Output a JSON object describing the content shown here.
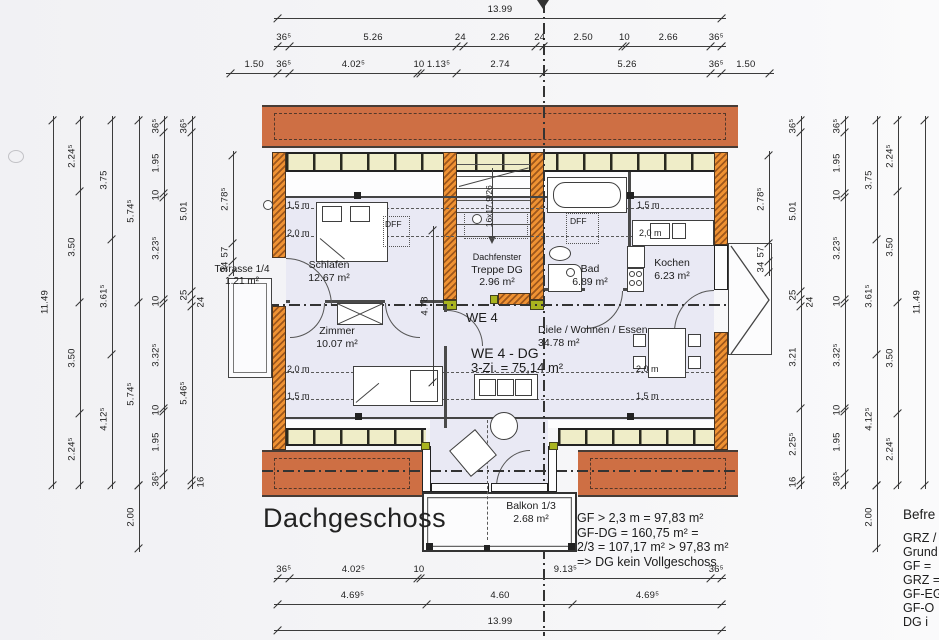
{
  "title": "Dachgeschoss",
  "apartment": {
    "we": "WE 4",
    "unit": "WE 4 - DG",
    "size": "3-Zi. = 75,14 m²"
  },
  "rooms": {
    "terrasse": {
      "name": "Terrasse 1/4",
      "area": "1.21 m²"
    },
    "schlafen": {
      "name": "Schlafen",
      "area": "12.67 m²"
    },
    "zimmer": {
      "name": "Zimmer",
      "area": "10.07 m²"
    },
    "treppe": {
      "name": "Treppe DG",
      "area": "2.96 m²",
      "note": "Dachfenster"
    },
    "bad": {
      "name": "Bad",
      "area": "6.89 m²"
    },
    "kochen": {
      "name": "Kochen",
      "area": "6.23 m²"
    },
    "diele": {
      "name": "Diele / Wohnen / Essen",
      "area": "34.78 m²"
    },
    "balkon": {
      "name": "Balkon 1/3",
      "area": "2.68 m²"
    }
  },
  "labels": {
    "dff": "DFF",
    "stair": "16x17,9/26",
    "h15": "1,5 m",
    "h20": "2,0 m"
  },
  "notes": {
    "calc": [
      "GF > 2,3 m = 97,83 m²",
      "GF-DG = 160,75 m² =",
      "2/3 = 107,17 m² > 97,83 m²",
      "=> DG kein Vollgeschoss"
    ],
    "right": [
      "Befre",
      "GRZ /",
      "Grund",
      "GF =",
      "GRZ =",
      "GF-EG",
      "GF-O",
      "DG i"
    ]
  },
  "colors": {
    "roof": "#ce6f44",
    "wall_hatch": "#ef9233",
    "window_band": "#efedc8",
    "floor": "#e9e9f4",
    "accent_green": "#a9b41f"
  },
  "scale_px_per_m": 31.74,
  "dim_chains": [
    {
      "name": "top-total",
      "axis": "h",
      "line": 18,
      "start": 278,
      "segs": [
        {
          "t": "13.99",
          "m": 13.99
        }
      ]
    },
    {
      "name": "top-row2",
      "axis": "h",
      "line": 46,
      "start": 278,
      "segs": [
        {
          "t": "36⁵",
          "m": 0.365
        },
        {
          "t": "5.26",
          "m": 5.26
        },
        {
          "t": "24",
          "m": 0.24
        },
        {
          "t": "2.26",
          "m": 2.26
        },
        {
          "t": "24",
          "m": 0.24
        },
        {
          "t": "2.50",
          "m": 2.5
        },
        {
          "t": "10",
          "m": 0.1
        },
        {
          "t": "2.66",
          "m": 2.66
        },
        {
          "t": "36⁵",
          "m": 0.365
        }
      ]
    },
    {
      "name": "top-row3",
      "axis": "h",
      "line": 73,
      "start": 230.4,
      "segs": [
        {
          "t": "1.50",
          "m": 1.5
        },
        {
          "t": "36⁵",
          "m": 0.365
        },
        {
          "t": "4.02⁵",
          "m": 4.025
        },
        {
          "t": "10",
          "m": 0.1
        },
        {
          "t": "1.13⁵",
          "m": 1.135
        },
        {
          "t": "2.74",
          "m": 2.74
        },
        {
          "t": "5.26",
          "m": 5.26
        },
        {
          "t": "36⁵",
          "m": 0.365
        },
        {
          "t": "1.50",
          "m": 1.5
        }
      ]
    },
    {
      "name": "bottom-row1",
      "axis": "h",
      "line": 578,
      "start": 278,
      "segs": [
        {
          "t": "36⁵",
          "m": 0.365
        },
        {
          "t": "4.02⁵",
          "m": 4.025
        },
        {
          "t": "10",
          "m": 0.1
        },
        {
          "t": "9.13⁵",
          "m": 9.135
        },
        {
          "t": "36⁵",
          "m": 0.365
        }
      ]
    },
    {
      "name": "bottom-row2",
      "axis": "h",
      "line": 604,
      "start": 278,
      "segs": [
        {
          "t": "4.69⁵",
          "m": 4.695
        },
        {
          "t": "4.60",
          "m": 4.6
        },
        {
          "t": "4.69⁵",
          "m": 4.695
        }
      ]
    },
    {
      "name": "bottom-total",
      "axis": "h",
      "line": 630,
      "start": 278,
      "segs": [
        {
          "t": "13.99",
          "m": 13.99
        }
      ]
    },
    {
      "name": "left-total",
      "axis": "v",
      "line": 53,
      "start": 120,
      "segs": [
        {
          "t": "11.49",
          "m": 11.49
        }
      ]
    },
    {
      "name": "left-2",
      "axis": "v",
      "line": 80,
      "start": 120,
      "segs": [
        {
          "t": "2.24⁵",
          "m": 2.245
        },
        {
          "t": "3.50",
          "m": 3.5
        },
        {
          "t": "3.50",
          "m": 3.5
        },
        {
          "t": "2.24⁵",
          "m": 2.245
        }
      ]
    },
    {
      "name": "left-3",
      "axis": "v",
      "line": 112,
      "start": 120,
      "segs": [
        {
          "t": "3.75",
          "m": 3.75
        },
        {
          "t": "3.61⁵",
          "m": 3.615
        },
        {
          "t": "4.12⁵",
          "m": 4.125
        }
      ]
    },
    {
      "name": "left-4",
      "axis": "v",
      "line": 139,
      "start": 120,
      "segs": [
        {
          "t": "5.74⁵",
          "m": 5.745
        },
        {
          "t": "5.74⁵",
          "m": 5.745
        }
      ]
    },
    {
      "name": "left-5",
      "axis": "v",
      "line": 164,
      "start": 120,
      "segs": [
        {
          "t": "36⁵",
          "m": 0.365
        },
        {
          "t": "1.95",
          "m": 1.95
        },
        {
          "t": "10",
          "m": 0.1
        },
        {
          "t": "3.23⁵",
          "m": 3.235
        },
        {
          "t": "10",
          "m": 0.1
        },
        {
          "t": "3.32⁵",
          "m": 3.325
        },
        {
          "t": "10",
          "m": 0.1
        },
        {
          "t": "1.95",
          "m": 1.95
        },
        {
          "t": "36⁵",
          "m": 0.365
        }
      ]
    },
    {
      "name": "left-6",
      "axis": "v",
      "line": 192,
      "start": 120,
      "segs": [
        {
          "t": "36⁵",
          "m": 0.365
        },
        {
          "t": "5.01",
          "m": 5.01
        },
        {
          "t": "25",
          "m": 0.25
        },
        {
          "t": "24",
          "m": 0.24
        },
        {
          "t": "5.46⁵",
          "m": 5.465
        },
        {
          "t": "16",
          "m": 0.16
        }
      ]
    },
    {
      "name": "left-wall",
      "axis": "v",
      "line": 233,
      "start": 155,
      "segs": [
        {
          "t": "2.78⁵",
          "m": 2.785
        },
        {
          "t": "57",
          "m": 0.57
        },
        {
          "t": "34",
          "m": 0.34
        }
      ]
    },
    {
      "name": "left-overhang",
      "axis": "v",
      "line": 139,
      "start": 485,
      "segs": [
        {
          "t": "2.00",
          "m": 2.0
        }
      ]
    },
    {
      "name": "right-wall",
      "axis": "v",
      "line": 769,
      "start": 155,
      "segs": [
        {
          "t": "2.78⁵",
          "m": 2.785
        },
        {
          "t": "57",
          "m": 0.57
        },
        {
          "t": "34",
          "m": 0.34
        }
      ]
    },
    {
      "name": "right-2",
      "axis": "v",
      "line": 801,
      "start": 120,
      "segs": [
        {
          "t": "36⁵",
          "m": 0.365
        },
        {
          "t": "5.01",
          "m": 5.01
        },
        {
          "t": "25",
          "m": 0.25
        },
        {
          "t": "24",
          "m": 0.24
        },
        {
          "t": "3.21",
          "m": 3.21
        },
        {
          "t": "2.25⁵",
          "m": 2.255
        },
        {
          "t": "16",
          "m": 0.16
        }
      ]
    },
    {
      "name": "right-3",
      "axis": "v",
      "line": 845,
      "start": 120,
      "segs": [
        {
          "t": "36⁵",
          "m": 0.365
        },
        {
          "t": "1.95",
          "m": 1.95
        },
        {
          "t": "10",
          "m": 0.1
        },
        {
          "t": "3.23⁵",
          "m": 3.235
        },
        {
          "t": "10",
          "m": 0.1
        },
        {
          "t": "3.32⁵",
          "m": 3.325
        },
        {
          "t": "10",
          "m": 0.1
        },
        {
          "t": "1.95",
          "m": 1.95
        },
        {
          "t": "36⁵",
          "m": 0.365
        }
      ]
    },
    {
      "name": "right-4",
      "axis": "v",
      "line": 877,
      "start": 120,
      "segs": [
        {
          "t": "3.75",
          "m": 3.75
        },
        {
          "t": "3.61⁵",
          "m": 3.615
        },
        {
          "t": "4.12⁵",
          "m": 4.125
        }
      ]
    },
    {
      "name": "right-5",
      "axis": "v",
      "line": 898,
      "start": 120,
      "segs": [
        {
          "t": "2.24⁵",
          "m": 2.245
        },
        {
          "t": "3.50",
          "m": 3.5
        },
        {
          "t": "3.50",
          "m": 3.5
        },
        {
          "t": "2.24⁵",
          "m": 2.245
        }
      ]
    },
    {
      "name": "right-total",
      "axis": "v",
      "line": 925,
      "start": 120,
      "segs": [
        {
          "t": "11.49",
          "m": 11.49
        }
      ]
    },
    {
      "name": "right-overhang",
      "axis": "v",
      "line": 877,
      "start": 485,
      "segs": [
        {
          "t": "2.00",
          "m": 2.0
        }
      ]
    },
    {
      "name": "interior-hall",
      "axis": "v",
      "line": 433,
      "start": 230,
      "segs": [
        {
          "t": "4.78",
          "m": 4.78
        }
      ]
    }
  ]
}
